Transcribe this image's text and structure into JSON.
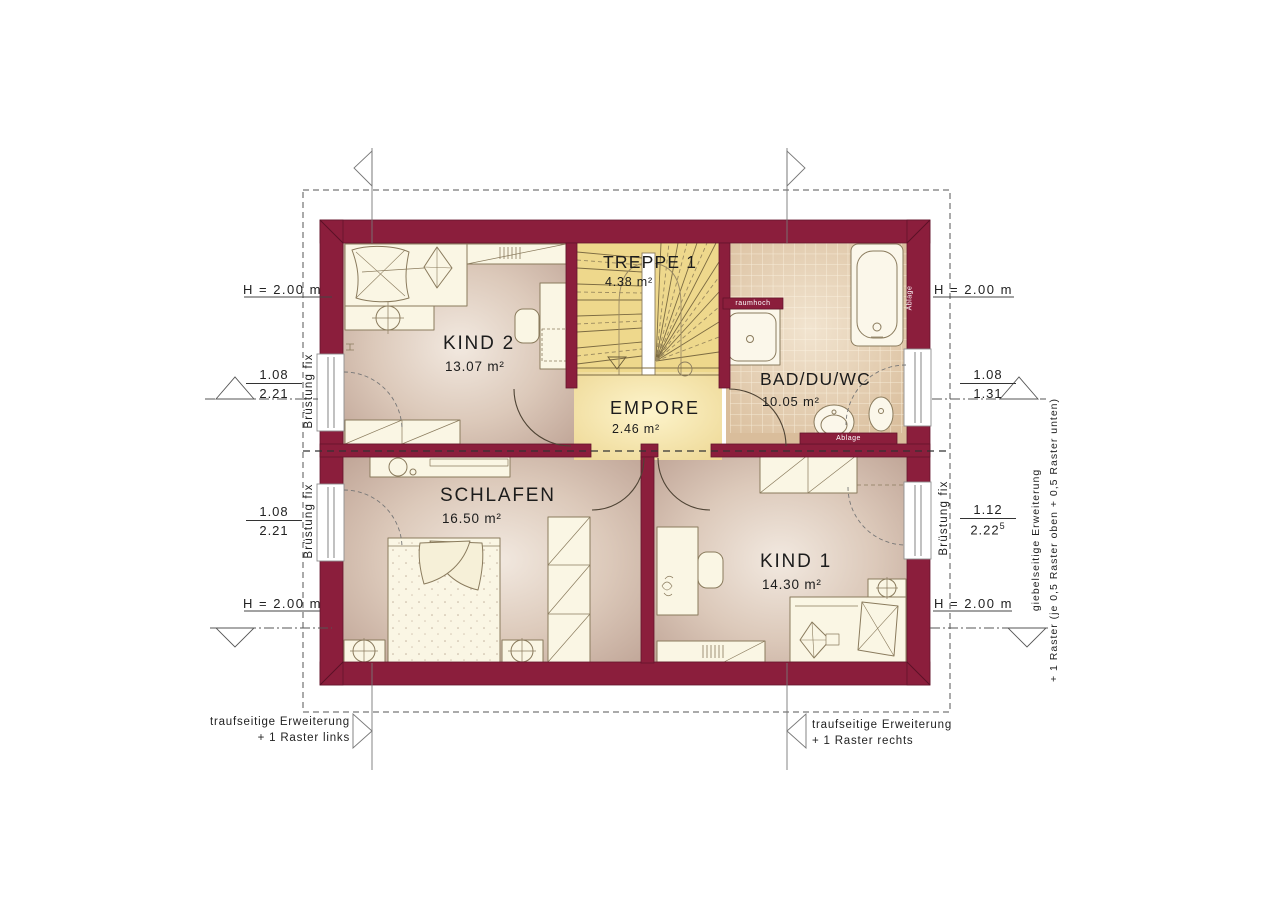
{
  "rooms": [
    {
      "id": "kind2",
      "name": "KIND 2",
      "area": "13.07 m²"
    },
    {
      "id": "treppe",
      "name": "TREPPE 1",
      "area": "4.38 m²"
    },
    {
      "id": "bad",
      "name": "BAD/DU/WC",
      "area": "10.05 m²"
    },
    {
      "id": "empore",
      "name": "EMPORE",
      "area": "2.46 m²"
    },
    {
      "id": "schlafen",
      "name": "SCHLAFEN",
      "area": "16.50 m²"
    },
    {
      "id": "kind1",
      "name": "KIND 1",
      "area": "14.30 m²"
    }
  ],
  "annotations": {
    "height_top_left": "H = 2.00 m",
    "height_top_right": "H = 2.00 m",
    "height_bottom_left": "H = 2.00 m",
    "height_bottom_right": "H = 2.00 m",
    "window_left_top": {
      "num": "1.08",
      "den": "2.21"
    },
    "window_left_bottom": {
      "num": "1.08",
      "den": "2.21"
    },
    "window_right_top": {
      "num": "1.08",
      "den": "1.31"
    },
    "window_right_bottom": {
      "num": "1.12",
      "den": "2.22",
      "sup": "5"
    },
    "bruestung_left_top": "Brüstung fix",
    "bruestung_left_bottom": "Brüstung fix",
    "bruestung_right": "Brüstung fix",
    "note_bottom_left_line1": "traufseitige Erweiterung",
    "note_bottom_left_line2": "+ 1 Raster links",
    "note_bottom_right_line1": "traufseitige Erweiterung",
    "note_bottom_right_line2": "+ 1 Raster rechts",
    "note_right_line1": "giebelseitige Erweiterung",
    "note_right_line2": "+ 1 Raster (je 0,5 Raster oben + 0,5 Raster unten)",
    "bath_raumhoch": "raumhoch",
    "bath_ablage_right": "Ablage",
    "bath_ablage_bottom": "Ablage"
  },
  "colors": {
    "wall": "#8b1e3c",
    "wall_edge": "#63132b",
    "floor_light": "#f1e8df",
    "floor_dark": "#bfa496",
    "stair": "#eed88c",
    "empore": "#eed793",
    "bath_tile": "#d9bd9b",
    "furniture": "#faf6e4",
    "line": "#555555"
  }
}
